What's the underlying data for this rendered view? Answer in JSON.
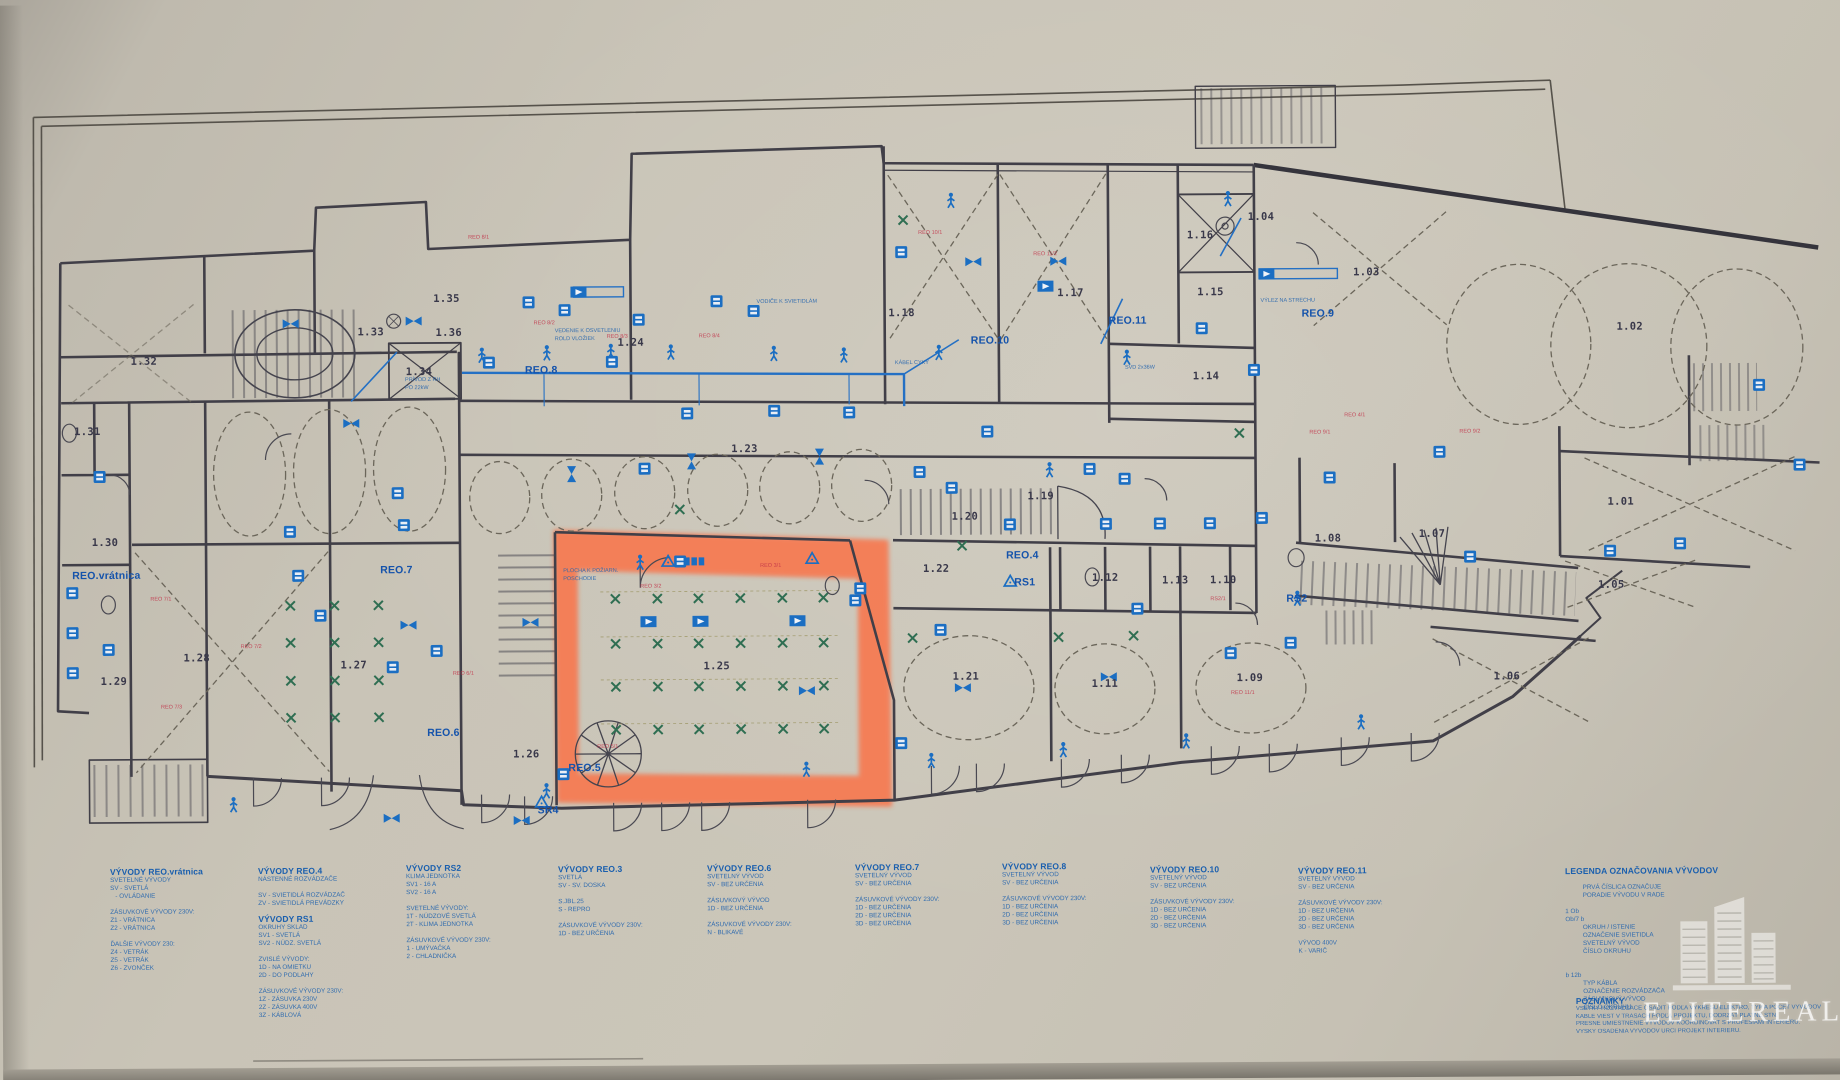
{
  "colors": {
    "paper": "#c9c4b7",
    "ink": "#413f48",
    "annotation_blue": "#1b6ec2",
    "circuit_red": "#c23349",
    "light_x_green": "#2f6e52",
    "highlight_orange": "#fa5a2d"
  },
  "watermark": {
    "text": "ELITEREAL"
  },
  "notes": {
    "title": "POZNÁMKY",
    "lines": [
      "VŠETKY ROZVÁDZAČE OSADIŤ PODĽA VÝKRESU ELEKTRO, TYP A POČET VÝVODOV UPRESNIŤ PRI REALIZÁCII.",
      "KÁBLE VIESŤ V TRASÁCH PODĽA PROJEKTU, DODRŽAŤ PLATNÉ STN.",
      "PRESNÉ UMIESTNENIE VÝVODOV KOORDINOVAŤ S PROFESIAMI INTERIÉRU.",
      "VÝŠKY OSADENIA VÝVODOV URČÍ PROJEKT INTERIÉRU."
    ]
  },
  "legend": {
    "blocks": [
      {
        "x": 108,
        "y": 862,
        "title": "VÝVODY REO.vrátnica",
        "lines": [
          "SVETELNÉ VÝVODY",
          "SV - SVETLÁ",
          "   - OVLÁDANIE",
          "",
          "ZÁSUVKOVÉ VÝVODY 230V:",
          "Z1 - VRÁTNICA",
          "Z2 - VRÁTNICA",
          "",
          "ĎALŠIE VÝVODY 230:",
          "Z4 - VETRÁK",
          "Z5 - VETRÁK",
          "Z6 - ZVONČEK"
        ]
      },
      {
        "x": 256,
        "y": 862,
        "title": "VÝVODY REO.4",
        "lines": [
          "NÁSTENNÉ ROZVÁDZAČE",
          "",
          "SV - SVIETIDLÁ ROZVÁDZAČ",
          "ZV - SVIETIDLÁ PREVÁDZKY"
        ]
      },
      {
        "x": 256,
        "y": 910,
        "title": "VÝVODY RS1",
        "lines": [
          "OKRUHY SKLAD",
          "SV1 - SVETLÁ",
          "SV2 - NÚDZ. SVETLÁ",
          "",
          "ZVISLÉ VÝVODY:",
          "1D - NA OMIETKU",
          "2D - DO PODLAHY",
          "",
          "ZÁSUVKOVÉ VÝVODY 230V:",
          "1Z - ZÁSUVKA 230V",
          "2Z - ZÁSUVKA 400V",
          "3Z - KÁBLOVÁ"
        ]
      },
      {
        "x": 404,
        "y": 860,
        "title": "VÝVODY RS2",
        "lines": [
          "KLIMA JEDNOTKA",
          "SV1 - 16 A",
          "SV2 - 16 A",
          "",
          "SVETELNÉ VÝVODY:",
          "1T - NÚDZOVÉ SVETLÁ",
          "2T - KLIMA JEDNOTKA",
          "",
          "ZÁSUVKOVÉ VÝVODY 230V:",
          "1 - UMÝVAČKA",
          "2 - CHLADNIČKA"
        ]
      },
      {
        "x": 556,
        "y": 862,
        "title": "VÝVODY REO.3",
        "lines": [
          "SVETLÁ",
          "SV - SV. DOSKA",
          "",
          "S.JBL.25",
          "S - REPRO",
          "",
          "ZÁSUVKOVÉ VÝVODY 230V:",
          "1D - BEZ URČENIA"
        ]
      },
      {
        "x": 705,
        "y": 862,
        "title": "VÝVODY REO.6",
        "lines": [
          "SVETELNÝ VÝVOD",
          "SV - BEZ URČENIA",
          "",
          "ZÁSUVKOVÝ VÝVOD",
          "1D - BEZ URČENIA",
          "",
          "ZÁSUVKOVÉ VÝVODY 230V:",
          "N - BLIKAVÉ"
        ]
      },
      {
        "x": 853,
        "y": 862,
        "title": "VÝVODY REO.7",
        "lines": [
          "SVETELNÝ VÝVOD",
          "SV - BEZ URČENIA",
          "",
          "ZÁSUVKOVÉ VÝVODY 230V:",
          "1D - BEZ URČENIA",
          "2D - BEZ URČENIA",
          "3D - BEZ URČENIA"
        ]
      },
      {
        "x": 1000,
        "y": 862,
        "title": "VÝVODY REO.8",
        "lines": [
          "SVETELNÝ VÝVOD",
          "SV - BEZ URČENIA",
          "",
          "ZÁSUVKOVÉ VÝVODY 230V:",
          "1D - BEZ URČENIA",
          "2D - BEZ URČENIA",
          "3D - BEZ URČENIA"
        ]
      },
      {
        "x": 1148,
        "y": 866,
        "title": "VÝVODY REO.10",
        "lines": [
          "SVETELNÝ VÝVOD",
          "SV - BEZ URČENIA",
          "",
          "ZÁSUVKOVÉ VÝVODY 230V:",
          "1D - BEZ URČENIA",
          "2D - BEZ URČENIA",
          "3D - BEZ URČENIA"
        ]
      },
      {
        "x": 1296,
        "y": 868,
        "title": "VÝVODY REO.11",
        "lines": [
          "SVETELNÝ VÝVOD",
          "SV - BEZ URČENIA",
          "",
          "ZÁSUVKOVÉ VÝVODY 230V:",
          "1D - BEZ URČENIA",
          "2D - BEZ URČENIA",
          "3D - BEZ URČENIA",
          "",
          "VÝVOD 400V",
          "K - VARIČ"
        ]
      },
      {
        "x": 1563,
        "y": 870,
        "title": "LEGENDA OZNAČOVANIA VÝVODOV",
        "lines": [
          "",
          "          PRVÁ ČÍSLICA OZNAČUJE",
          "          PORADIE VÝVODU V RADE",
          "",
          "1 Ob",
          "Ob/7 b",
          "          OKRUH / ISTENIE",
          "          OZNAČENIE SVIETIDLA",
          "          SVETELNÝ VÝVOD",
          "          ČÍSLO OKRUHU",
          "",
          "",
          "b 12b",
          "          TYP KÁBLA",
          "          OZNAČENIE ROZVÁDZAČA",
          "          ZÁSUVKOVÝ VÝVOD",
          "          ČÍSLO OKRUHU"
        ]
      }
    ]
  },
  "plan": {
    "rooms": [
      {
        "id": "1.01",
        "x": 1621,
        "y": 506
      },
      {
        "id": "1.02",
        "x": 1631,
        "y": 331
      },
      {
        "id": "1.03",
        "x": 1368,
        "y": 275
      },
      {
        "id": "1.04",
        "x": 1263,
        "y": 219
      },
      {
        "id": "1.05",
        "x": 1611,
        "y": 589
      },
      {
        "id": "1.06",
        "x": 1506,
        "y": 680
      },
      {
        "id": "1.07",
        "x": 1432,
        "y": 537
      },
      {
        "id": "1.08",
        "x": 1328,
        "y": 541
      },
      {
        "id": "1.09",
        "x": 1249,
        "y": 680
      },
      {
        "id": "1.10",
        "x": 1223,
        "y": 582
      },
      {
        "id": "1.11",
        "x": 1104,
        "y": 685
      },
      {
        "id": "1.12",
        "x": 1105,
        "y": 579
      },
      {
        "id": "1.13",
        "x": 1175,
        "y": 582
      },
      {
        "id": "1.14",
        "x": 1207,
        "y": 378
      },
      {
        "id": "1.15",
        "x": 1212,
        "y": 294
      },
      {
        "id": "1.16",
        "x": 1202,
        "y": 237
      },
      {
        "id": "1.17",
        "x": 1072,
        "y": 294
      },
      {
        "id": "1.18",
        "x": 903,
        "y": 313
      },
      {
        "id": "1.19",
        "x": 1041,
        "y": 497
      },
      {
        "id": "1.20",
        "x": 965,
        "y": 517
      },
      {
        "id": "1.21",
        "x": 965,
        "y": 677
      },
      {
        "id": "1.22",
        "x": 936,
        "y": 569
      },
      {
        "id": "1.23",
        "x": 745,
        "y": 448
      },
      {
        "id": "1.24",
        "x": 632,
        "y": 341
      },
      {
        "id": "1.25",
        "x": 716,
        "y": 665
      },
      {
        "id": "1.26",
        "x": 525,
        "y": 752
      },
      {
        "id": "1.27",
        "x": 353,
        "y": 662
      },
      {
        "id": "1.28",
        "x": 196,
        "y": 654
      },
      {
        "id": "1.29",
        "x": 113,
        "y": 677
      },
      {
        "id": "1.30",
        "x": 105,
        "y": 538
      },
      {
        "id": "1.31",
        "x": 88,
        "y": 427
      },
      {
        "id": "1.32",
        "x": 145,
        "y": 357
      },
      {
        "id": "1.33",
        "x": 372,
        "y": 329
      },
      {
        "id": "1.34",
        "x": 420,
        "y": 369
      },
      {
        "id": "1.35",
        "x": 448,
        "y": 296
      },
      {
        "id": "1.36",
        "x": 450,
        "y": 330
      }
    ],
    "panels": [
      {
        "id": "REO.vrátnica",
        "x": 72,
        "y": 571
      },
      {
        "id": "REO.7",
        "x": 380,
        "y": 567
      },
      {
        "id": "REO.6",
        "x": 426,
        "y": 730
      },
      {
        "id": "REO.5",
        "x": 567,
        "y": 766
      },
      {
        "id": "SR4",
        "x": 536,
        "y": 808
      },
      {
        "id": "REO.8",
        "x": 526,
        "y": 368
      },
      {
        "id": "REO.4",
        "x": 1006,
        "y": 556
      },
      {
        "id": "RS1",
        "x": 1014,
        "y": 583
      },
      {
        "id": "RS2",
        "x": 1286,
        "y": 601
      },
      {
        "id": "REO.9",
        "x": 1303,
        "y": 316
      },
      {
        "id": "REO.10",
        "x": 972,
        "y": 341
      },
      {
        "id": "REO.11",
        "x": 1110,
        "y": 322
      }
    ],
    "red_labels": [
      {
        "t": "REO 7/1",
        "x": 150,
        "y": 592
      },
      {
        "t": "REO 7/2",
        "x": 240,
        "y": 640
      },
      {
        "t": "REO 7/3",
        "x": 160,
        "y": 700
      },
      {
        "t": "REO 8/1",
        "x": 470,
        "y": 232
      },
      {
        "t": "REO 8/2",
        "x": 535,
        "y": 318
      },
      {
        "t": "REO 8/3",
        "x": 608,
        "y": 332
      },
      {
        "t": "REO 8/4",
        "x": 700,
        "y": 332
      },
      {
        "t": "REO 11/2",
        "x": 1035,
        "y": 252
      },
      {
        "t": "REO 10/1",
        "x": 920,
        "y": 230
      },
      {
        "t": "REO 3/2",
        "x": 640,
        "y": 582
      },
      {
        "t": "REO 3/1",
        "x": 760,
        "y": 562
      },
      {
        "t": "RS2/1",
        "x": 1210,
        "y": 598
      },
      {
        "t": "REO 9/1",
        "x": 1310,
        "y": 432
      },
      {
        "t": "REO 9/2",
        "x": 1460,
        "y": 432
      },
      {
        "t": "REO 11/1",
        "x": 1230,
        "y": 692
      },
      {
        "t": "REO 4/1",
        "x": 1345,
        "y": 415
      },
      {
        "t": "REO 5/1",
        "x": 596,
        "y": 742
      },
      {
        "t": "REO 6/1",
        "x": 452,
        "y": 668
      }
    ],
    "blue_notes": [
      {
        "t": "PLOCHA K POŽIARN.",
        "x": 563,
        "y": 566
      },
      {
        "t": "POSCHODIE",
        "x": 563,
        "y": 574
      },
      {
        "t": "VEDENIE K OSVETLENIU",
        "x": 556,
        "y": 326
      },
      {
        "t": "ROLD VLOŽIEK",
        "x": 556,
        "y": 334
      },
      {
        "t": "PRÍVOD Z RH",
        "x": 406,
        "y": 374
      },
      {
        "t": "PO 22kW",
        "x": 406,
        "y": 382
      },
      {
        "t": "VODIČE K SVIETIDLÁM",
        "x": 758,
        "y": 298
      },
      {
        "t": "SVD 2x36W",
        "x": 1126,
        "y": 366
      },
      {
        "t": "KÁBEL CYKY",
        "x": 896,
        "y": 360
      },
      {
        "t": "VÝLEZ NA STRECHU",
        "x": 1262,
        "y": 300
      }
    ],
    "symbols": {
      "person": [
        [
          483,
          352
        ],
        [
          548,
          350
        ],
        [
          612,
          349
        ],
        [
          672,
          350
        ],
        [
          775,
          352
        ],
        [
          845,
          354
        ],
        [
          940,
          352
        ],
        [
          1128,
          358
        ],
        [
          953,
          200
        ],
        [
          1230,
          200
        ],
        [
          232,
          800
        ],
        [
          545,
          788
        ],
        [
          805,
          768
        ],
        [
          930,
          760
        ],
        [
          1062,
          750
        ],
        [
          1185,
          742
        ],
        [
          1360,
          724
        ],
        [
          640,
          560
        ],
        [
          1050,
          470
        ],
        [
          1297,
          600
        ]
      ],
      "box": [
        [
          72,
          588
        ],
        [
          72,
          628
        ],
        [
          72,
          668
        ],
        [
          100,
          472
        ],
        [
          108,
          645
        ],
        [
          290,
          528
        ],
        [
          298,
          572
        ],
        [
          320,
          612
        ],
        [
          398,
          490
        ],
        [
          404,
          522
        ],
        [
          436,
          648
        ],
        [
          392,
          664
        ],
        [
          530,
          300
        ],
        [
          566,
          308
        ],
        [
          640,
          318
        ],
        [
          718,
          300
        ],
        [
          755,
          310
        ],
        [
          613,
          360
        ],
        [
          490,
          360
        ],
        [
          952,
          488
        ],
        [
          988,
          432
        ],
        [
          1090,
          470
        ],
        [
          1125,
          480
        ],
        [
          1255,
          372
        ],
        [
          903,
          252
        ],
        [
          645,
          467
        ],
        [
          688,
          412
        ],
        [
          775,
          410
        ],
        [
          850,
          412
        ],
        [
          920,
          472
        ],
        [
          1010,
          525
        ],
        [
          1106,
          525
        ],
        [
          1160,
          525
        ],
        [
          1210,
          525
        ],
        [
          1262,
          520
        ],
        [
          1330,
          480
        ],
        [
          1440,
          455
        ],
        [
          1470,
          560
        ],
        [
          1610,
          555
        ],
        [
          1680,
          548
        ],
        [
          1230,
          655
        ],
        [
          1290,
          645
        ],
        [
          1137,
          610
        ],
        [
          940,
          630
        ],
        [
          855,
          600
        ],
        [
          1203,
          330
        ],
        [
          680,
          560
        ],
        [
          1760,
          390
        ],
        [
          1800,
          470
        ],
        [
          860,
          588
        ],
        [
          900,
          743
        ],
        [
          562,
          772
        ]
      ],
      "speaker": [
        [
          648,
          620
        ],
        [
          700,
          620
        ],
        [
          797,
          620
        ],
        [
          580,
          290
        ],
        [
          1268,
          276
        ],
        [
          1047,
          287
        ]
      ],
      "valve": [
        [
          292,
          320
        ],
        [
          415,
          318
        ],
        [
          352,
          420
        ],
        [
          408,
          622
        ],
        [
          530,
          620
        ],
        [
          390,
          815
        ],
        [
          520,
          818
        ],
        [
          806,
          690
        ],
        [
          962,
          688
        ],
        [
          1108,
          678
        ],
        [
          975,
          262
        ],
        [
          1060,
          262
        ]
      ],
      "valvev": [
        [
          572,
          472
        ],
        [
          692,
          460
        ],
        [
          820,
          456
        ]
      ],
      "xmark": [
        [
          615,
          597
        ],
        [
          657,
          597
        ],
        [
          698,
          597
        ],
        [
          740,
          597
        ],
        [
          782,
          597
        ],
        [
          823,
          597
        ],
        [
          615,
          642
        ],
        [
          657,
          642
        ],
        [
          698,
          642
        ],
        [
          740,
          642
        ],
        [
          782,
          642
        ],
        [
          823,
          642
        ],
        [
          615,
          685
        ],
        [
          657,
          685
        ],
        [
          698,
          685
        ],
        [
          740,
          685
        ],
        [
          782,
          685
        ],
        [
          823,
          685
        ],
        [
          615,
          728
        ],
        [
          657,
          728
        ],
        [
          698,
          728
        ],
        [
          740,
          728
        ],
        [
          782,
          728
        ],
        [
          823,
          728
        ],
        [
          290,
          602
        ],
        [
          334,
          602
        ],
        [
          378,
          602
        ],
        [
          290,
          639
        ],
        [
          334,
          639
        ],
        [
          378,
          639
        ],
        [
          290,
          677
        ],
        [
          334,
          677
        ],
        [
          378,
          677
        ],
        [
          290,
          714
        ],
        [
          334,
          714
        ],
        [
          378,
          714
        ],
        [
          912,
          638
        ],
        [
          1058,
          638
        ],
        [
          1133,
          637
        ],
        [
          962,
          546
        ],
        [
          1240,
          435
        ],
        [
          905,
          220
        ],
        [
          680,
          508
        ]
      ],
      "tri": [
        [
          668,
          560
        ],
        [
          812,
          558
        ],
        [
          540,
          800
        ],
        [
          1010,
          582
        ]
      ],
      "uuu": [
        [
          694,
          560
        ]
      ]
    }
  }
}
